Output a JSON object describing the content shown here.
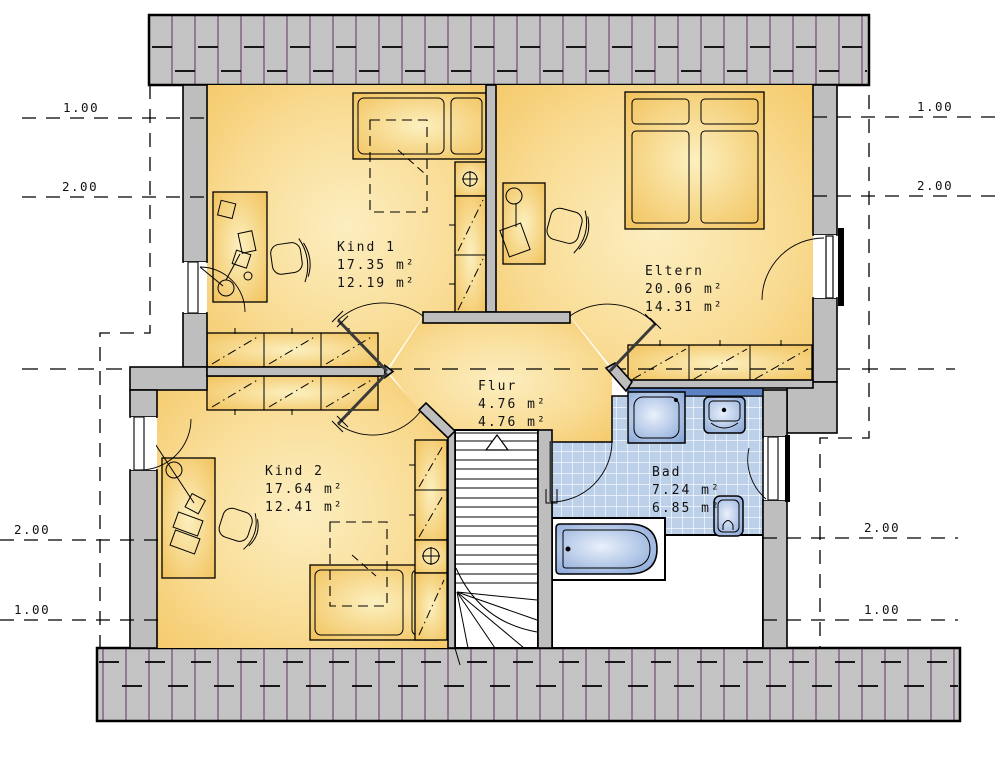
{
  "plan_type": "floorplan-attic",
  "rooms": [
    {
      "id": "kind1",
      "name": "Kind 1",
      "area_gross": "17.35 m²",
      "area_living": "12.19 m²"
    },
    {
      "id": "eltern",
      "name": "Eltern",
      "area_gross": "20.06 m²",
      "area_living": "14.31 m²"
    },
    {
      "id": "kind2",
      "name": "Kind 2",
      "area_gross": "17.64 m²",
      "area_living": "12.41 m²"
    },
    {
      "id": "flur",
      "name": "Flur",
      "area_gross": "4.76 m²",
      "area_living": "4.76 m²"
    },
    {
      "id": "bad",
      "name": "Bad",
      "area_gross": "7.24 m²",
      "area_living": "6.85 m²"
    }
  ],
  "dimension_labels": {
    "left_top": [
      "1.00",
      "2.00"
    ],
    "right_top": [
      "1.00",
      "2.00"
    ],
    "left_bottom": [
      "2.00",
      "1.00"
    ],
    "right_bottom": [
      "2.00",
      "1.00"
    ]
  },
  "colors": {
    "floor_yellow_edge": "#F4C765",
    "floor_yellow_center": "#FCEEC0",
    "wall_gray": "#BEBEBE",
    "roof_gray": "#C3C3C3",
    "roof_line_purple": "#7B517B",
    "tile_blue": "#BDD0EA",
    "fixture_blue": "#7C9DD3",
    "fixture_blue_light": "#E9F1FB",
    "counter_blue": "#5D83C4",
    "outline_black": "#000000"
  }
}
